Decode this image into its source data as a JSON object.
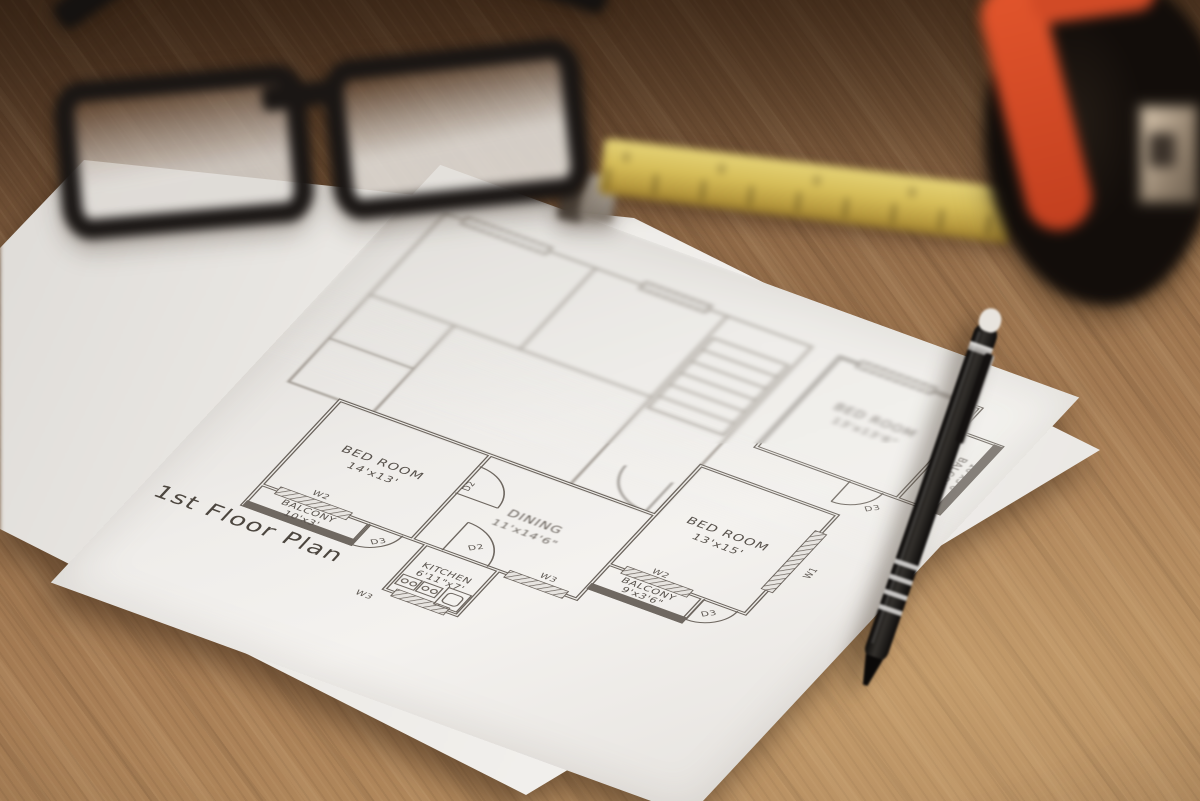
{
  "floor_plan": {
    "title": "1st Floor Plan",
    "rooms": {
      "bedroom1": {
        "name": "BED ROOM",
        "size": "14'x13'"
      },
      "balcony1": {
        "name": "BALCONY",
        "size": "10'x3'"
      },
      "kitchen": {
        "name": "KITCHEN",
        "size": "6'11\"x7'"
      },
      "dining": {
        "name": "DINING",
        "size": "11'x14'6\""
      },
      "bedroom2": {
        "name": "BED ROOM",
        "size": "13'x15'"
      },
      "balcony2": {
        "name": "BALCONY",
        "size": "9'x3'6\""
      },
      "bedroom3": {
        "name": "BED ROOM",
        "size": "13'x13'6\""
      },
      "balcony3": {
        "name": "BALCONY",
        "size": "10'x3'6\""
      }
    },
    "markers": [
      "W2",
      "D3",
      "D2",
      "D2",
      "W3",
      "W3",
      "W2",
      "D3",
      "W1",
      "D3"
    ]
  },
  "colors": {
    "wood": "#9a7450",
    "wood_dark": "#4f3826",
    "wood_light": "#b28a5e",
    "paper": "#eceae6",
    "ink": "#57514b",
    "tape_measure_accent": "#d94f2a",
    "ruler_yellow": "#d6bd58",
    "pen_black": "#17120f"
  }
}
